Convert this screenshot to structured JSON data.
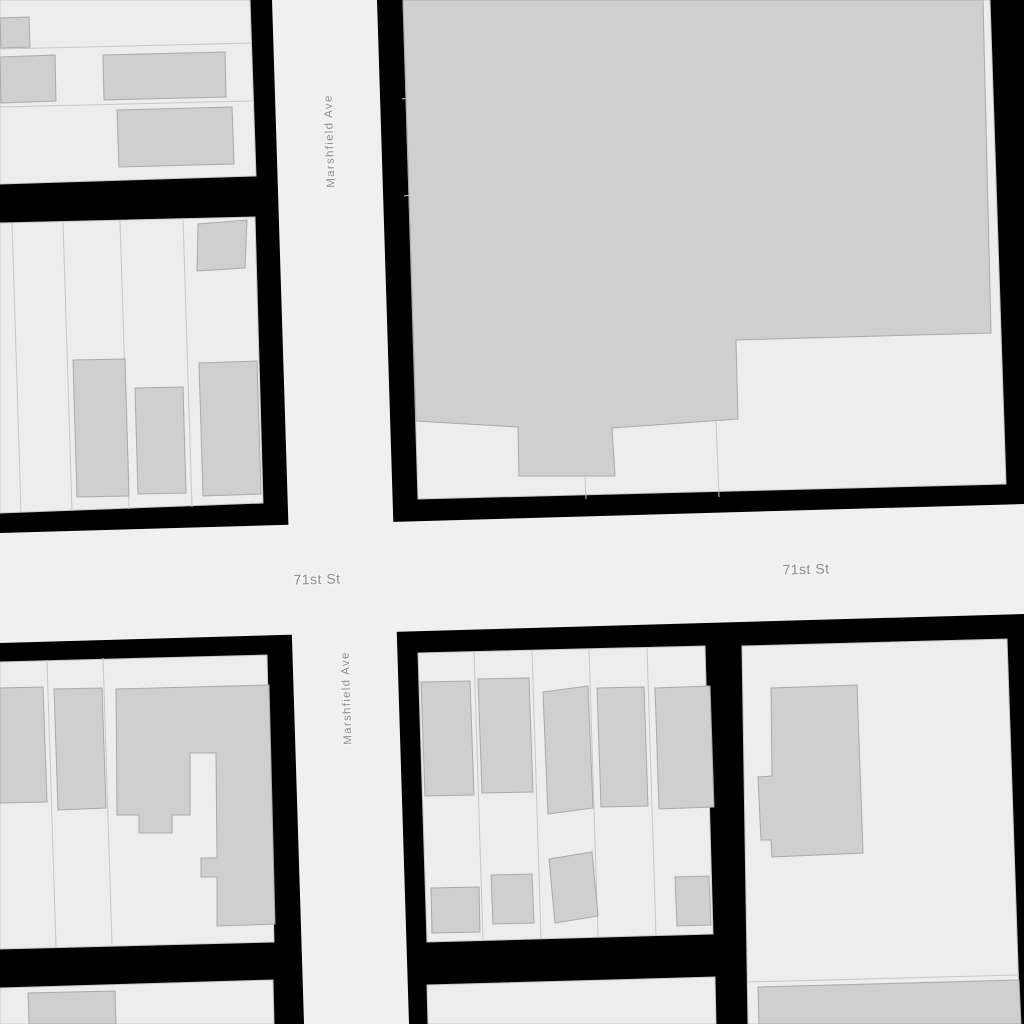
{
  "map": {
    "streets": [
      "71st St",
      "Marshfield Ave"
    ],
    "colors": {
      "background": "#000000",
      "road_fill": "#f0f0f0",
      "parcel_fill": "#ededed",
      "parcel_stroke": "#c7c7c7",
      "building_fill": "#cfcfcf",
      "building_stroke": "#a9a9a9",
      "label_color": "#8f8f8f",
      "label_halo": "#f4f4f4"
    },
    "roads": [
      {
        "name": "71st St",
        "points": [
          [
            0,
            533
          ],
          [
            1024,
            504
          ],
          [
            1024,
            614
          ],
          [
            0,
            643
          ]
        ]
      },
      {
        "name": "Marshfield Ave",
        "points": [
          [
            272,
            0
          ],
          [
            377,
            0
          ],
          [
            409,
            1024
          ],
          [
            304,
            1024
          ]
        ]
      }
    ],
    "blocks": [
      {
        "name": "block-nw-top",
        "points": [
          [
            0,
            0
          ],
          [
            250,
            0
          ],
          [
            256,
            176
          ],
          [
            0,
            184
          ]
        ]
      },
      {
        "name": "block-nw-mid",
        "points": [
          [
            0,
            223
          ],
          [
            255,
            217
          ],
          [
            263,
            503
          ],
          [
            0,
            513
          ]
        ]
      },
      {
        "name": "block-ne",
        "points": [
          [
            403,
            0
          ],
          [
            990,
            0
          ],
          [
            1006,
            484
          ],
          [
            418,
            499
          ]
        ]
      },
      {
        "name": "block-sw",
        "points": [
          [
            0,
            662
          ],
          [
            267,
            655
          ],
          [
            274,
            942
          ],
          [
            0,
            949
          ]
        ]
      },
      {
        "name": "block-se-mid",
        "points": [
          [
            418,
            653
          ],
          [
            705,
            646
          ],
          [
            713,
            934
          ],
          [
            427,
            942
          ]
        ]
      },
      {
        "name": "block-se-right",
        "points": [
          [
            742,
            646
          ],
          [
            1007,
            639
          ],
          [
            1020,
            1024
          ],
          [
            748,
            1024
          ]
        ]
      },
      {
        "name": "block-bottom-left",
        "points": [
          [
            0,
            988
          ],
          [
            273,
            980
          ],
          [
            274,
            1024
          ],
          [
            0,
            1024
          ]
        ]
      },
      {
        "name": "block-bottom-mid",
        "points": [
          [
            427,
            985
          ],
          [
            715,
            977
          ],
          [
            716,
            1024
          ],
          [
            428,
            1024
          ]
        ]
      }
    ],
    "parcel_lines": [
      {
        "points": [
          [
            0,
            49
          ],
          [
            252,
            43
          ]
        ]
      },
      {
        "points": [
          [
            0,
            107
          ],
          [
            254,
            101
          ]
        ]
      },
      {
        "points": [
          [
            12,
            223
          ],
          [
            21,
            512
          ]
        ]
      },
      {
        "points": [
          [
            63,
            221
          ],
          [
            72,
            511
          ]
        ]
      },
      {
        "points": [
          [
            120,
            220
          ],
          [
            129,
            509
          ]
        ]
      },
      {
        "points": [
          [
            183,
            218
          ],
          [
            192,
            507
          ]
        ]
      },
      {
        "points": [
          [
            402,
            99
          ],
          [
            409,
            98
          ]
        ]
      },
      {
        "points": [
          [
            404,
            196
          ],
          [
            411,
            195
          ]
        ]
      },
      {
        "points": [
          [
            585,
            477
          ],
          [
            586,
            499
          ]
        ]
      },
      {
        "points": [
          [
            716,
            421
          ],
          [
            719,
            497
          ]
        ]
      },
      {
        "points": [
          [
            47,
            660
          ],
          [
            56,
            947
          ]
        ]
      },
      {
        "points": [
          [
            103,
            658
          ],
          [
            112,
            945
          ]
        ]
      },
      {
        "points": [
          [
            474,
            652
          ],
          [
            483,
            941
          ]
        ]
      },
      {
        "points": [
          [
            532,
            650
          ],
          [
            541,
            939
          ]
        ]
      },
      {
        "points": [
          [
            589,
            649
          ],
          [
            598,
            937
          ]
        ]
      },
      {
        "points": [
          [
            647,
            647
          ],
          [
            656,
            936
          ]
        ]
      },
      {
        "points": [
          [
            748,
            982
          ],
          [
            1019,
            975
          ]
        ]
      }
    ],
    "buildings": [
      {
        "name": "building-nw-top-1",
        "points": [
          [
            0,
            18
          ],
          [
            29,
            17
          ],
          [
            30,
            47
          ],
          [
            1,
            48
          ]
        ]
      },
      {
        "name": "building-nw-top-2",
        "points": [
          [
            0,
            57
          ],
          [
            55,
            55
          ],
          [
            56,
            101
          ],
          [
            1,
            103
          ]
        ]
      },
      {
        "name": "building-nw-top-3",
        "points": [
          [
            103,
            55
          ],
          [
            225,
            52
          ],
          [
            226,
            97
          ],
          [
            104,
            100
          ]
        ]
      },
      {
        "name": "building-nw-top-4",
        "points": [
          [
            117,
            110
          ],
          [
            232,
            107
          ],
          [
            234,
            164
          ],
          [
            119,
            167
          ]
        ]
      },
      {
        "name": "building-nw-mid-1",
        "points": [
          [
            198,
            224
          ],
          [
            247,
            220
          ],
          [
            245,
            268
          ],
          [
            197,
            271
          ]
        ]
      },
      {
        "name": "building-nw-mid-2",
        "points": [
          [
            73,
            360
          ],
          [
            125,
            359
          ],
          [
            129,
            496
          ],
          [
            77,
            497
          ]
        ]
      },
      {
        "name": "building-nw-mid-3",
        "points": [
          [
            135,
            388
          ],
          [
            183,
            387
          ],
          [
            186,
            493
          ],
          [
            138,
            494
          ]
        ]
      },
      {
        "name": "building-nw-mid-4",
        "points": [
          [
            199,
            363
          ],
          [
            257,
            361
          ],
          [
            261,
            494
          ],
          [
            203,
            496
          ]
        ]
      },
      {
        "name": "building-ne-large",
        "points": [
          [
            403,
            0
          ],
          [
            983,
            0
          ],
          [
            991,
            333
          ],
          [
            736,
            340
          ],
          [
            738,
            419
          ],
          [
            612,
            428
          ],
          [
            615,
            476
          ],
          [
            519,
            476
          ],
          [
            518,
            427
          ],
          [
            416,
            421
          ]
        ]
      },
      {
        "name": "building-sw-1",
        "points": [
          [
            0,
            688
          ],
          [
            43,
            687
          ],
          [
            47,
            802
          ],
          [
            0,
            803
          ]
        ]
      },
      {
        "name": "building-sw-2",
        "points": [
          [
            54,
            689
          ],
          [
            102,
            688
          ],
          [
            106,
            808
          ],
          [
            58,
            810
          ]
        ]
      },
      {
        "name": "building-sw-large",
        "points": [
          [
            116,
            689
          ],
          [
            269,
            685
          ],
          [
            275,
            924
          ],
          [
            217,
            926
          ],
          [
            217,
            877
          ],
          [
            201,
            877
          ],
          [
            201,
            858
          ],
          [
            217,
            858
          ],
          [
            216,
            753
          ],
          [
            190,
            753
          ],
          [
            190,
            815
          ],
          [
            172,
            815
          ],
          [
            172,
            833
          ],
          [
            139,
            833
          ],
          [
            139,
            815
          ],
          [
            117,
            815
          ]
        ]
      },
      {
        "name": "building-se-mid-1",
        "points": [
          [
            421,
            682
          ],
          [
            470,
            681
          ],
          [
            474,
            795
          ],
          [
            425,
            796
          ]
        ]
      },
      {
        "name": "building-se-mid-2",
        "points": [
          [
            478,
            679
          ],
          [
            529,
            678
          ],
          [
            533,
            792
          ],
          [
            482,
            793
          ]
        ]
      },
      {
        "name": "building-se-mid-3",
        "points": [
          [
            543,
            692
          ],
          [
            588,
            686
          ],
          [
            593,
            808
          ],
          [
            548,
            814
          ]
        ]
      },
      {
        "name": "building-se-mid-4",
        "points": [
          [
            597,
            688
          ],
          [
            644,
            687
          ],
          [
            648,
            806
          ],
          [
            601,
            807
          ]
        ]
      },
      {
        "name": "building-se-mid-5",
        "points": [
          [
            655,
            688
          ],
          [
            710,
            686
          ],
          [
            714,
            807
          ],
          [
            659,
            809
          ]
        ]
      },
      {
        "name": "building-se-mid-6",
        "points": [
          [
            431,
            888
          ],
          [
            479,
            887
          ],
          [
            480,
            932
          ],
          [
            432,
            933
          ]
        ]
      },
      {
        "name": "building-se-mid-7",
        "points": [
          [
            491,
            875
          ],
          [
            532,
            874
          ],
          [
            534,
            923
          ],
          [
            493,
            924
          ]
        ]
      },
      {
        "name": "building-se-mid-8",
        "points": [
          [
            549,
            859
          ],
          [
            592,
            852
          ],
          [
            598,
            916
          ],
          [
            555,
            923
          ]
        ]
      },
      {
        "name": "building-se-mid-9",
        "points": [
          [
            675,
            877
          ],
          [
            709,
            876
          ],
          [
            711,
            925
          ],
          [
            677,
            926
          ]
        ]
      },
      {
        "name": "building-se-right-1",
        "points": [
          [
            771,
            688
          ],
          [
            857,
            685
          ],
          [
            863,
            853
          ],
          [
            772,
            857
          ],
          [
            771,
            840
          ],
          [
            761,
            840
          ],
          [
            758,
            777
          ],
          [
            772,
            776
          ]
        ]
      },
      {
        "name": "building-se-right-2",
        "points": [
          [
            758,
            987
          ],
          [
            1019,
            980
          ],
          [
            1021,
            1024
          ],
          [
            759,
            1024
          ]
        ]
      },
      {
        "name": "building-bottom-left-1",
        "points": [
          [
            28,
            993
          ],
          [
            115,
            991
          ],
          [
            116,
            1024
          ],
          [
            29,
            1024
          ]
        ]
      }
    ],
    "labels": [
      {
        "text": "Marshfield Ave",
        "x": 330,
        "y": 141,
        "rotation": -91.8,
        "font_size": 11.5,
        "letter_spacing": 1.3
      },
      {
        "text": "Marshfield Ave",
        "x": 347,
        "y": 698,
        "rotation": -91.8,
        "font_size": 11.5,
        "letter_spacing": 1.3
      },
      {
        "text": "71st St",
        "x": 317,
        "y": 579,
        "rotation": -1.6,
        "font_size": 14,
        "letter_spacing": 0.5
      },
      {
        "text": "71st St",
        "x": 806,
        "y": 569,
        "rotation": -1.6,
        "font_size": 14,
        "letter_spacing": 0.5
      }
    ]
  }
}
